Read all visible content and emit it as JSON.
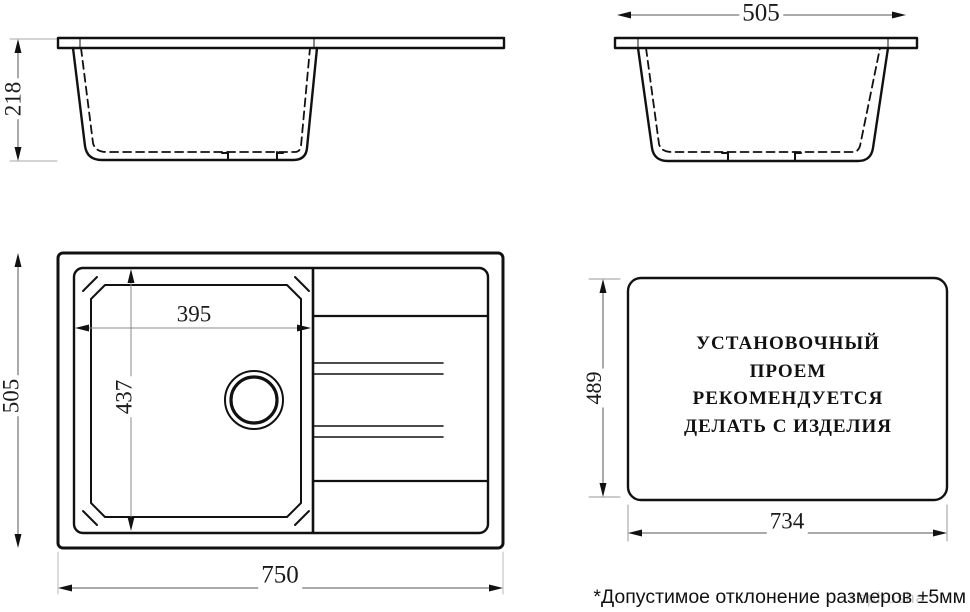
{
  "views": {
    "side_section_long": {
      "depth": "218"
    },
    "side_section_short": {
      "width": "505"
    },
    "top_view": {
      "overall_width": "750",
      "overall_depth": "505",
      "bowl_width": "395",
      "bowl_depth": "437"
    },
    "installation_cutout": {
      "width": "734",
      "depth": "489",
      "note_lines": [
        "УСТАНОВОЧНЫЙ",
        "ПРОЕМ",
        "РЕКОМЕНДУЕТСЯ",
        "ДЕЛАТЬ С ИЗДЕЛИЯ"
      ]
    }
  },
  "footnote": "*Допустимое отклонение размеров ±5мм",
  "watermark": "sephosha",
  "colors": {
    "line": "#111111",
    "dim_line": "#666666",
    "extension_line": "#aaaaaa",
    "background": "#ffffff"
  }
}
